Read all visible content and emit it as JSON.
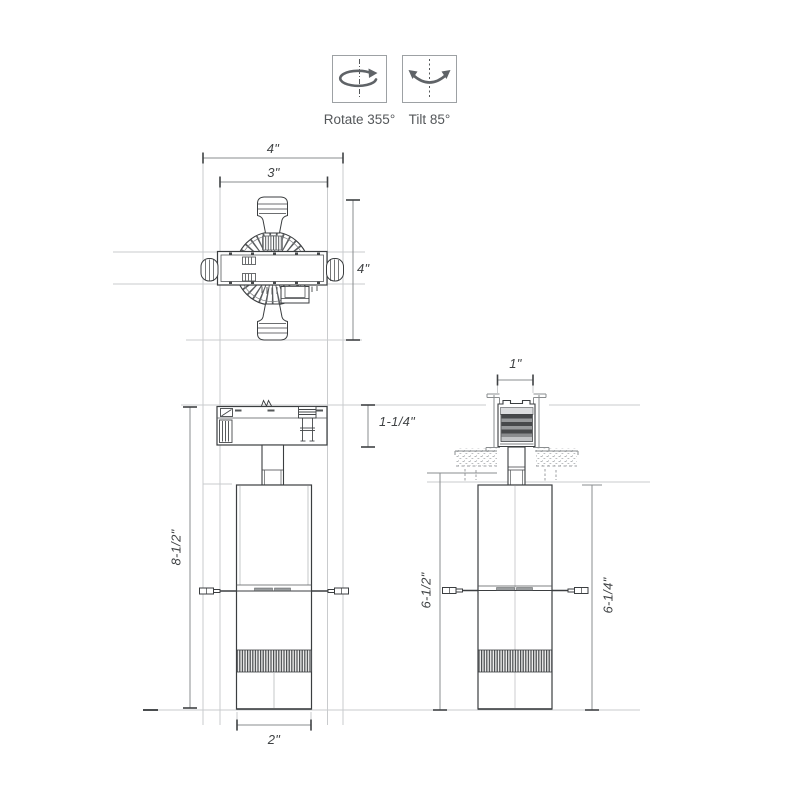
{
  "legend": {
    "rotate_label": "Rotate 355°",
    "tilt_label": "Tilt 85°"
  },
  "dimensions": {
    "top_view_width_outer": "4\"",
    "top_view_width_inner": "3\"",
    "top_view_depth": "4\"",
    "adapter_height": "1-1/4\"",
    "overall_height": "8-1/2\"",
    "body_width": "2\"",
    "recessed_opening": "1\"",
    "recessed_height_left": "6-1/2\"",
    "recessed_height_right": "6-1/4\""
  },
  "colors": {
    "fixture_line": "#3b3e40",
    "construction_line": "#c9cbcd",
    "dimension_line": "#8a8d8f",
    "text": "#3f4244",
    "icon_stroke": "#5f6367",
    "background": "#ffffff"
  }
}
